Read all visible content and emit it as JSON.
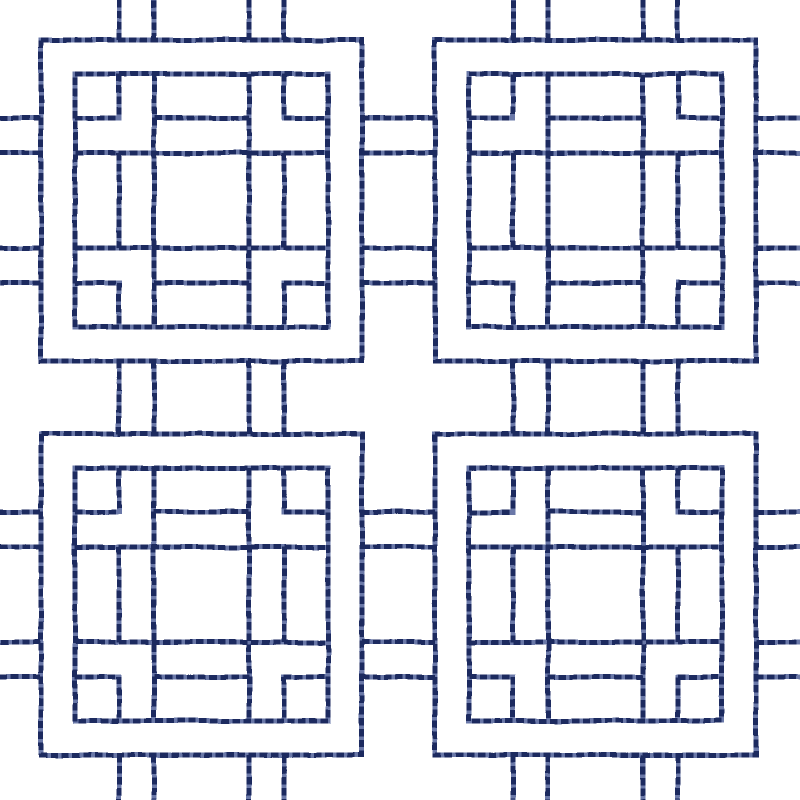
{
  "canvas": {
    "width": 800,
    "height": 800,
    "background_color": "#ffffff"
  },
  "pattern": {
    "kind": "square-lattice-stitch-motif",
    "stitch_style": {
      "stroke_width": 5,
      "base_color": "#6b78a8",
      "dash_color": "#1b2a5e",
      "dash_length": 7.5,
      "gap_length": 3.5
    },
    "tile": {
      "size": 321,
      "origins": [
        [
          41,
          40
        ],
        [
          435,
          40
        ],
        [
          41,
          434
        ],
        [
          435,
          434
        ]
      ],
      "squares": [
        [
          0,
          0,
          321
        ],
        [
          34,
          34,
          253
        ]
      ],
      "lines": [
        [
          113,
          34,
          113,
          287
        ],
        [
          208,
          34,
          208,
          287
        ],
        [
          34,
          113,
          287,
          113
        ],
        [
          34,
          208,
          287,
          208
        ],
        [
          113,
          78,
          208,
          78
        ],
        [
          113,
          243,
          208,
          243
        ],
        [
          78,
          113,
          78,
          208
        ],
        [
          243,
          113,
          243,
          208
        ],
        [
          78,
          34,
          78,
          78
        ],
        [
          34,
          78,
          78,
          78
        ],
        [
          243,
          34,
          243,
          78
        ],
        [
          243,
          78,
          287,
          78
        ],
        [
          78,
          243,
          78,
          287
        ],
        [
          34,
          243,
          78,
          243
        ],
        [
          243,
          243,
          243,
          287
        ],
        [
          243,
          243,
          287,
          243
        ]
      ]
    },
    "connectors": {
      "offsets": [
        78,
        113,
        208,
        243
      ],
      "row_origins_y": [
        40,
        434
      ],
      "col_origins_x": [
        41,
        435
      ],
      "horizontal_x_spans": [
        [
          0,
          41
        ],
        [
          362,
          435
        ],
        [
          756,
          800
        ]
      ],
      "vertical_y_spans": [
        [
          0,
          40
        ],
        [
          361,
          434
        ],
        [
          755,
          800
        ]
      ]
    },
    "wobble": {
      "base_frequency": 0.024,
      "octaves": 2,
      "seed": 7,
      "displacement_scale": 3,
      "blur": 0.35
    }
  }
}
